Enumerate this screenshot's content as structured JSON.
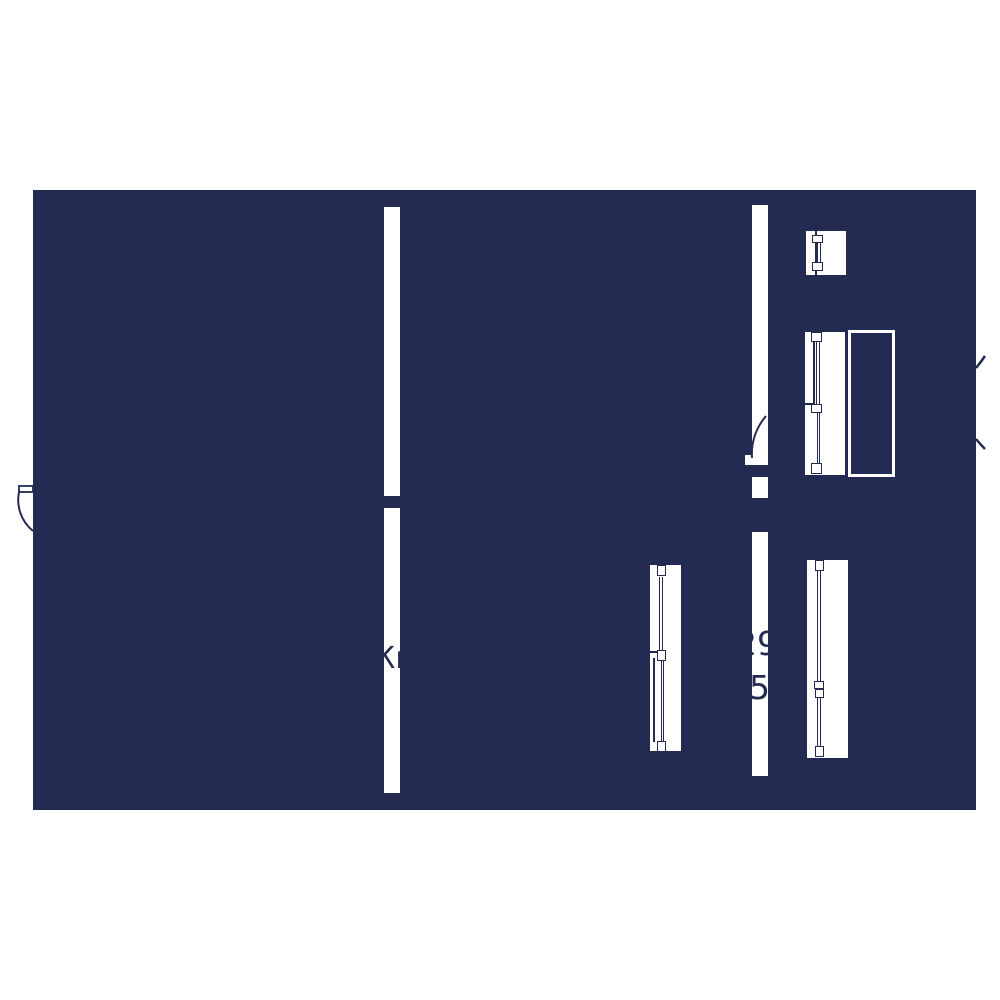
{
  "plan": {
    "type": "floor-plan-drawing",
    "colors": {
      "background": "#ffffff",
      "fill": "#242B53",
      "line": "#242B53",
      "label_text": "#242B53"
    },
    "labels": {
      "room_left_fragment": "Жи",
      "area_right_line1": "29",
      "area_right_line2": "5"
    },
    "elements": {
      "slab": "floor-slab",
      "wall_gaps": 5,
      "windows": 4,
      "glazed_panel_outline": 1,
      "door_swing_arcs": 4
    }
  }
}
